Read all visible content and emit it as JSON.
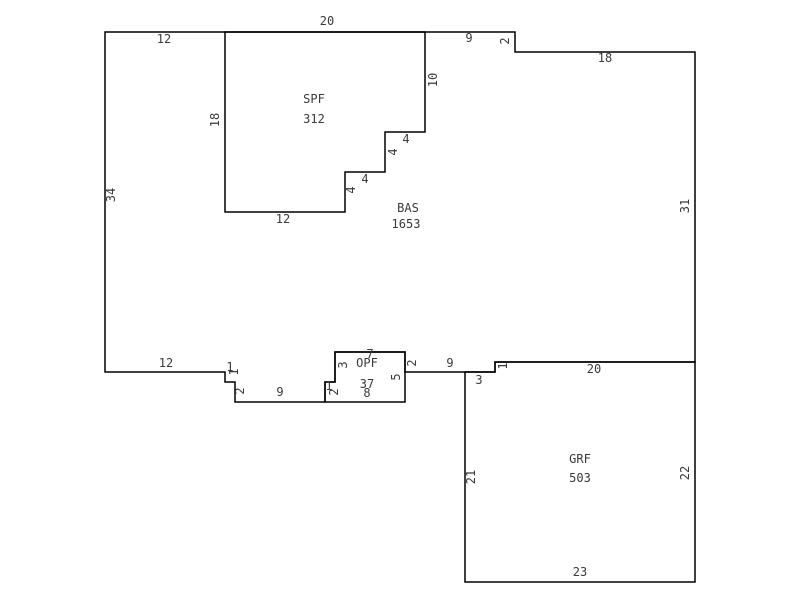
{
  "sketch": {
    "background_color": "#ffffff",
    "line_color": "#000000",
    "text_color": "#3a3a3a",
    "rooms": [
      {
        "code": "SPF",
        "area": "312"
      },
      {
        "code": "BAS",
        "area": "1653"
      },
      {
        "code": "OPF",
        "area": "37"
      },
      {
        "code": "GRF",
        "area": "503"
      }
    ],
    "polygons": [
      {
        "name": "bas-outline",
        "points": "105,32 515,32 515,52 695,52 695,362 495,362 495,372 405,372 405,352 335,352 335,382 325,382 325,402 235,402 235,382 225,382 225,372 105,372"
      },
      {
        "name": "spf-outline",
        "points": "225,32 425,32 425,132 385,132 385,172 345,172 345,212 225,212"
      },
      {
        "name": "opf-outline",
        "points": "335,352 405,352 405,402 325,402 325,382 335,382"
      },
      {
        "name": "grf-outline",
        "points": "465,372 495,372 495,362 695,362 695,582 465,582"
      }
    ],
    "labels": [
      {
        "text": "12",
        "x": 164,
        "y": 39,
        "rot": 0,
        "kind": "dim"
      },
      {
        "text": "20",
        "x": 327,
        "y": 21,
        "rot": 0,
        "kind": "dim"
      },
      {
        "text": "9",
        "x": 469,
        "y": 38,
        "rot": 0,
        "kind": "dim"
      },
      {
        "text": "2",
        "x": 505,
        "y": 41,
        "rot": 1,
        "kind": "dim"
      },
      {
        "text": "18",
        "x": 605,
        "y": 58,
        "rot": 0,
        "kind": "dim"
      },
      {
        "text": "31",
        "x": 685,
        "y": 206,
        "rot": 1,
        "kind": "dim"
      },
      {
        "text": "34",
        "x": 111,
        "y": 195,
        "rot": 1,
        "kind": "dim"
      },
      {
        "text": "18",
        "x": 215,
        "y": 120,
        "rot": 1,
        "kind": "dim"
      },
      {
        "text": "10",
        "x": 433,
        "y": 80,
        "rot": 1,
        "kind": "dim"
      },
      {
        "text": "4",
        "x": 406,
        "y": 139,
        "rot": 0,
        "kind": "dim"
      },
      {
        "text": "4",
        "x": 393,
        "y": 152,
        "rot": 1,
        "kind": "dim"
      },
      {
        "text": "4",
        "x": 365,
        "y": 179,
        "rot": 0,
        "kind": "dim"
      },
      {
        "text": "4",
        "x": 351,
        "y": 190,
        "rot": 1,
        "kind": "dim"
      },
      {
        "text": "12",
        "x": 283,
        "y": 219,
        "rot": 0,
        "kind": "dim"
      },
      {
        "text": "SPF",
        "x": 314,
        "y": 99,
        "rot": 0,
        "kind": "room"
      },
      {
        "text": "312",
        "x": 314,
        "y": 119,
        "rot": 0,
        "kind": "area"
      },
      {
        "text": "BAS",
        "x": 408,
        "y": 208,
        "rot": 0,
        "kind": "room"
      },
      {
        "text": "1653",
        "x": 406,
        "y": 224,
        "rot": 0,
        "kind": "area"
      },
      {
        "text": "12",
        "x": 166,
        "y": 363,
        "rot": 0,
        "kind": "dim"
      },
      {
        "text": "1",
        "x": 230,
        "y": 367,
        "rot": 0,
        "kind": "dim"
      },
      {
        "text": "1",
        "x": 234,
        "y": 372,
        "rot": 1,
        "kind": "dim"
      },
      {
        "text": "2",
        "x": 240,
        "y": 391,
        "rot": 1,
        "kind": "dim"
      },
      {
        "text": "9",
        "x": 280,
        "y": 392,
        "rot": 0,
        "kind": "dim"
      },
      {
        "text": "1",
        "x": 329,
        "y": 386,
        "rot": 0,
        "kind": "dim"
      },
      {
        "text": "2",
        "x": 334,
        "y": 392,
        "rot": 1,
        "kind": "dim"
      },
      {
        "text": "3",
        "x": 343,
        "y": 365,
        "rot": 1,
        "kind": "dim"
      },
      {
        "text": "7",
        "x": 370,
        "y": 354,
        "rot": 0,
        "kind": "dim"
      },
      {
        "text": "OPF",
        "x": 367,
        "y": 363,
        "rot": 0,
        "kind": "room"
      },
      {
        "text": "37",
        "x": 367,
        "y": 384,
        "rot": 0,
        "kind": "area"
      },
      {
        "text": "8",
        "x": 367,
        "y": 393,
        "rot": 0,
        "kind": "dim"
      },
      {
        "text": "5",
        "x": 396,
        "y": 377,
        "rot": 1,
        "kind": "dim"
      },
      {
        "text": "2",
        "x": 412,
        "y": 363,
        "rot": 1,
        "kind": "dim"
      },
      {
        "text": "9",
        "x": 450,
        "y": 363,
        "rot": 0,
        "kind": "dim"
      },
      {
        "text": "3",
        "x": 479,
        "y": 380,
        "rot": 0,
        "kind": "dim"
      },
      {
        "text": "1",
        "x": 503,
        "y": 366,
        "rot": 1,
        "kind": "dim"
      },
      {
        "text": "20",
        "x": 594,
        "y": 369,
        "rot": 0,
        "kind": "dim"
      },
      {
        "text": "21",
        "x": 471,
        "y": 477,
        "rot": 1,
        "kind": "dim"
      },
      {
        "text": "GRF",
        "x": 580,
        "y": 459,
        "rot": 0,
        "kind": "room"
      },
      {
        "text": "503",
        "x": 580,
        "y": 478,
        "rot": 0,
        "kind": "area"
      },
      {
        "text": "22",
        "x": 685,
        "y": 473,
        "rot": 1,
        "kind": "dim"
      },
      {
        "text": "23",
        "x": 580,
        "y": 572,
        "rot": 0,
        "kind": "dim"
      }
    ]
  }
}
